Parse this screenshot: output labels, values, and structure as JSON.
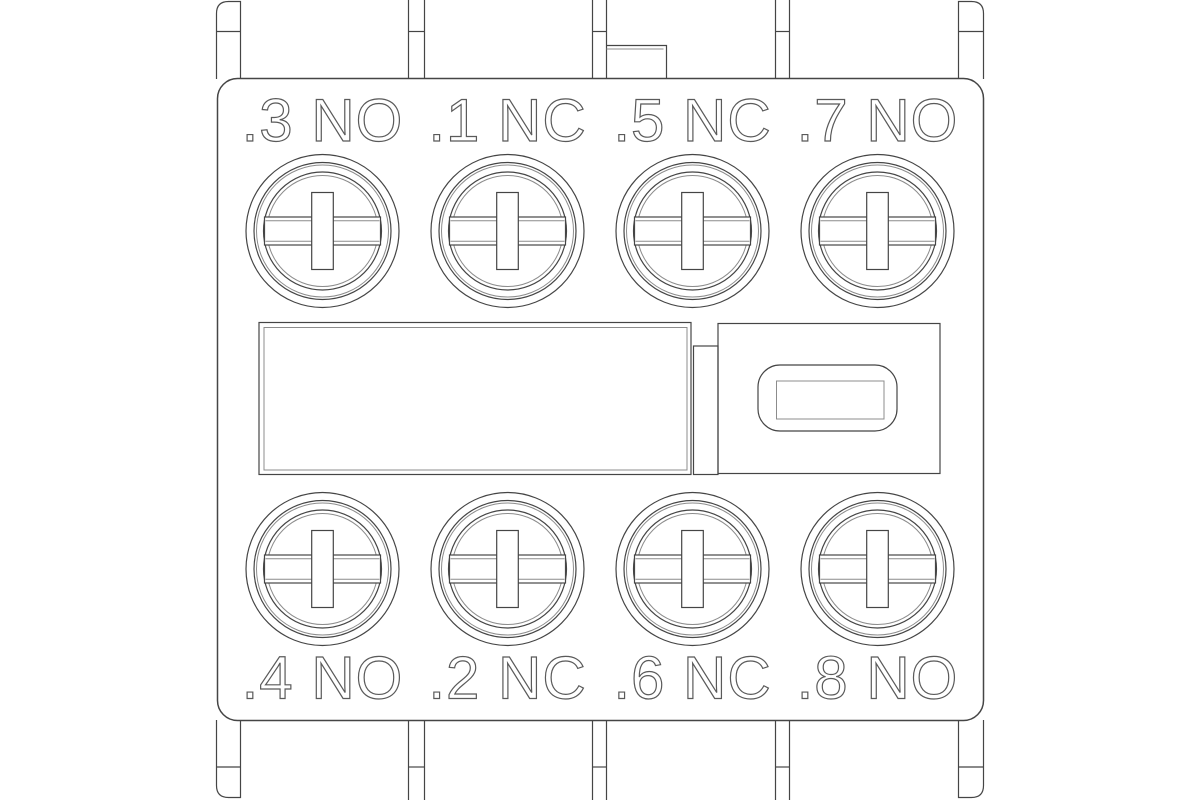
{
  "terminals": {
    "top": [
      {
        "label": ".3 NO"
      },
      {
        "label": ".1 NC"
      },
      {
        "label": ".5 NC"
      },
      {
        "label": ".7 NO"
      }
    ],
    "bottom": [
      {
        "label": ".4 NO"
      },
      {
        "label": ".2 NC"
      },
      {
        "label": ".6 NC"
      },
      {
        "label": ".8 NO"
      }
    ]
  },
  "colors": {
    "background": "#ffffff",
    "line": "#454545",
    "line_light": "#8c8c8c",
    "text": "#5a5a5a"
  }
}
